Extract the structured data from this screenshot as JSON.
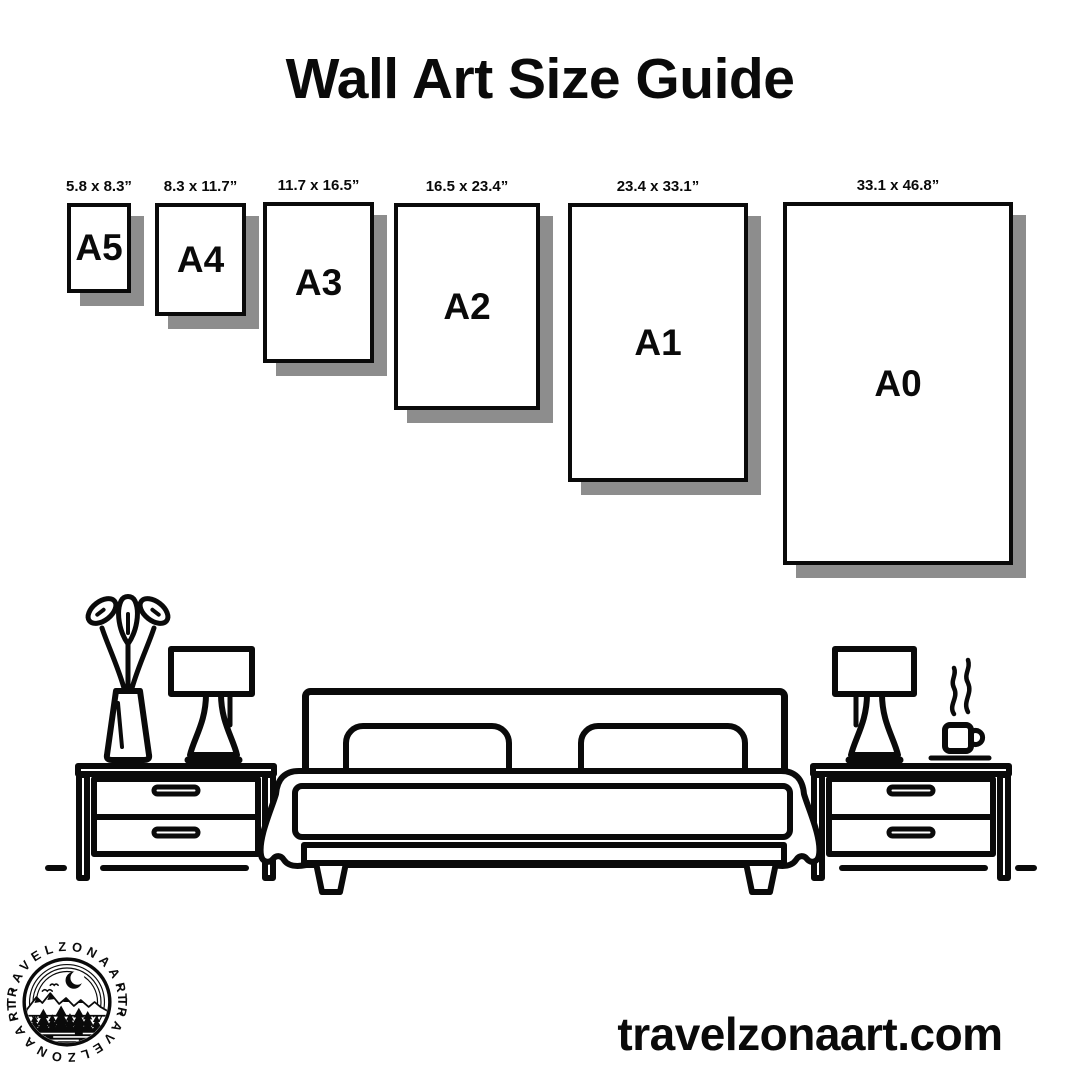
{
  "poster": {
    "title": "Wall Art Size Guide",
    "website_url": "travelzonaart.com"
  },
  "size_guide": {
    "unit": "inches",
    "frames": [
      {
        "name": "A5",
        "size": "5.8 x 8.3”"
      },
      {
        "name": "A4",
        "size": "8.3 x 11.7”"
      },
      {
        "name": "A3",
        "size": "11.7 x 16.5”"
      },
      {
        "name": "A2",
        "size": "16.5 x 23.4”"
      },
      {
        "name": "A1",
        "size": "23.4 x 33.1”"
      },
      {
        "name": "A0",
        "size": "33.1 x 46.8”"
      }
    ]
  },
  "logo": {
    "brand": "TRAVELZONAART",
    "arc_text": "•TRAVELZONAART•"
  },
  "illustration": {
    "scene": "bedroom",
    "elements": [
      "plant-vase",
      "table-lamp-left",
      "nightstand-left",
      "double-bed",
      "pillows",
      "blanket",
      "nightstand-right",
      "table-lamp-right",
      "coffee-cup-with-steam"
    ]
  },
  "colors": {
    "ink": "#0a0a0a",
    "frame_shadow": "#8d8d8d",
    "background": "#ffffff"
  }
}
